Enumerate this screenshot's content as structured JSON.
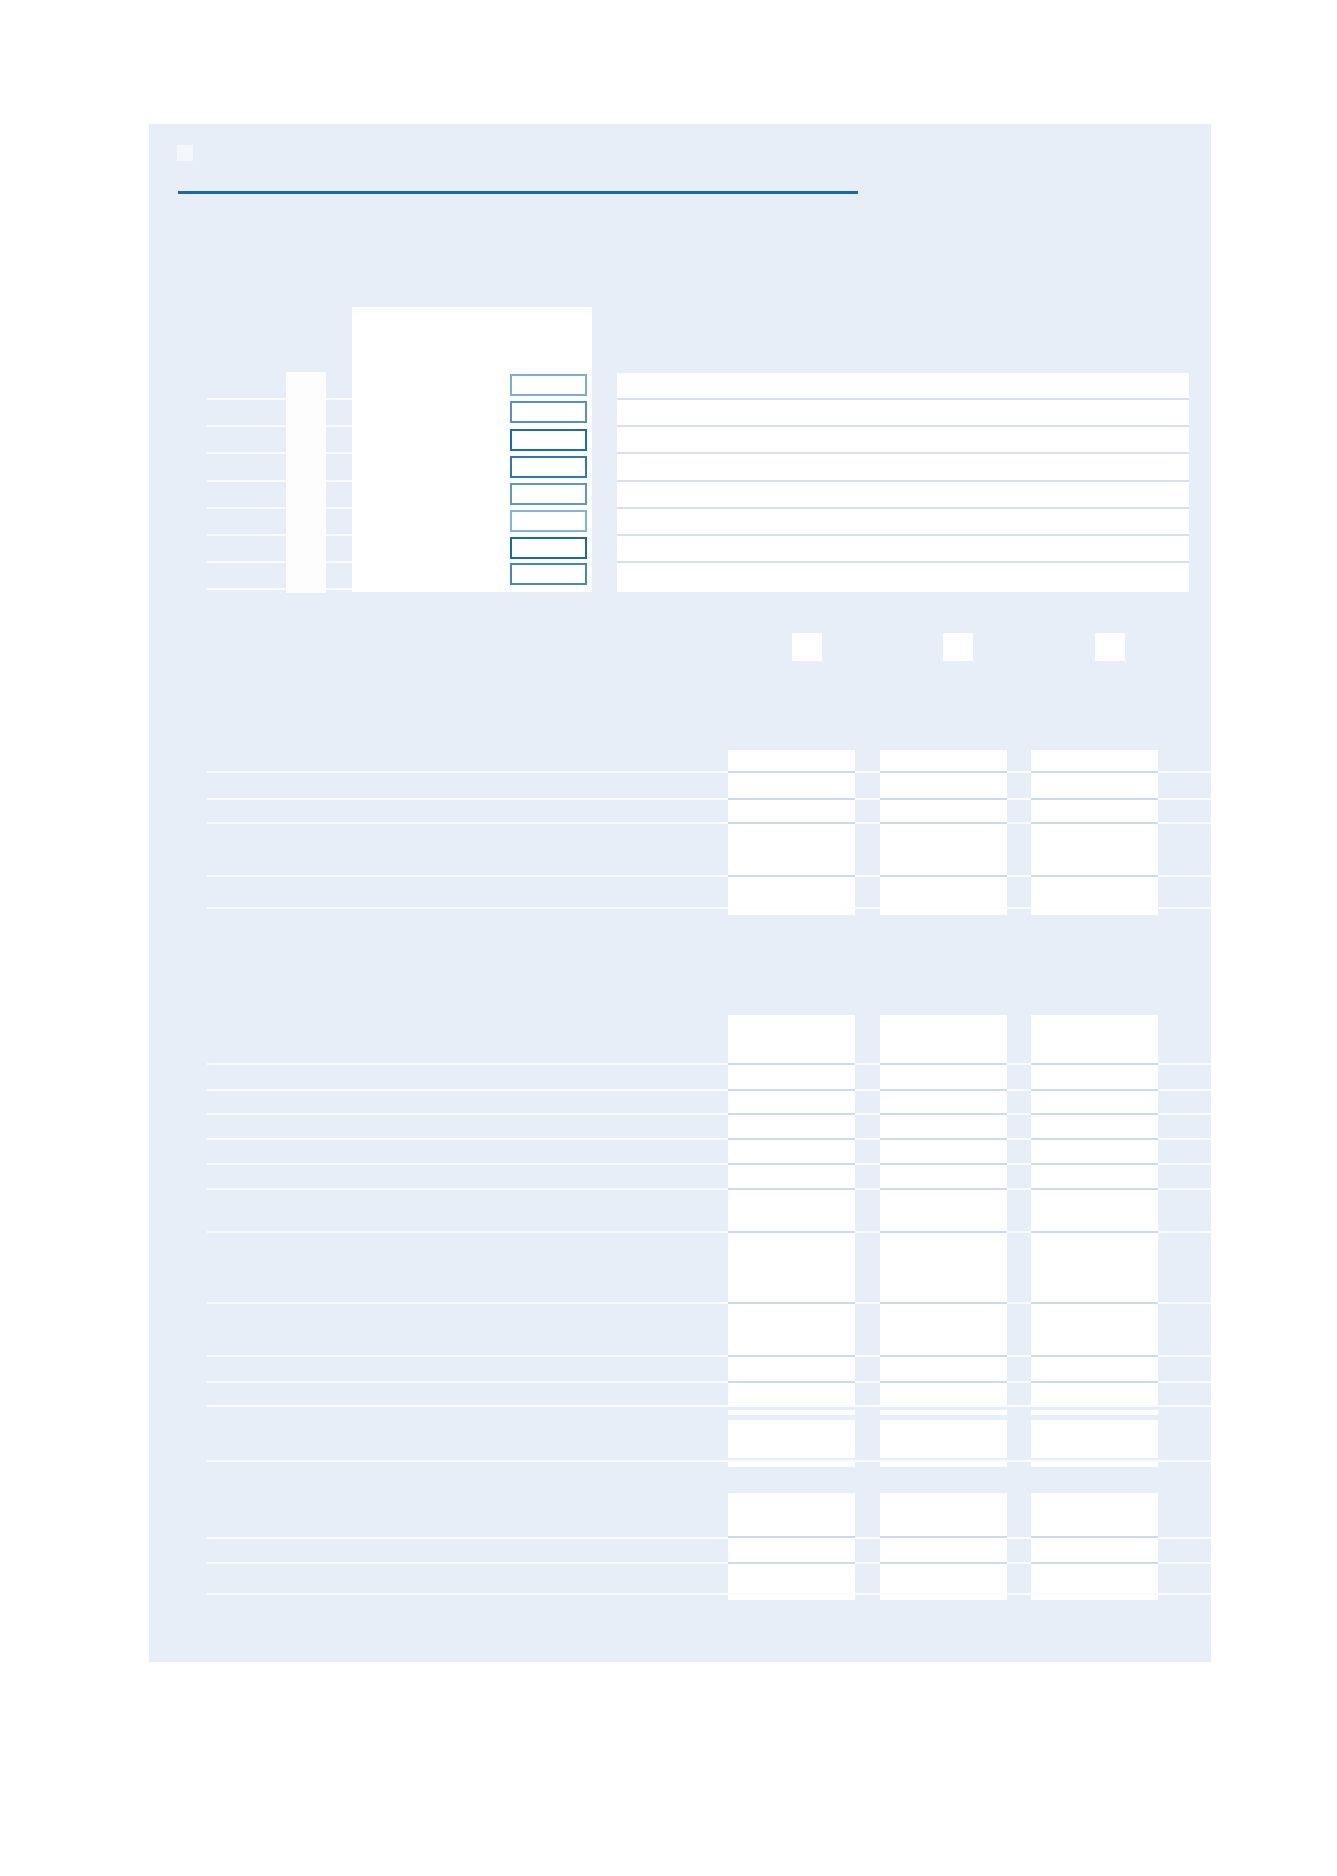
{
  "document": {
    "kind": "blank-form-template-page",
    "visible_text": "",
    "notes": "Empty form page: no text is rendered in the pixels; only panel, rule, boxes, checkboxes, row guidelines and three-column table cells."
  },
  "colors": {
    "page_bg": "#ffffff",
    "panel_bg": "#e8eef8",
    "accent_rule": "#1769ab",
    "cell_separator": "#cdd9ec",
    "answer_row_separator": "#d6e0f0",
    "guideline": "#f9fbfe",
    "block_white": "#ffffff",
    "icon_square": "#f4f8fc",
    "checkbox_fill": "#ffffff",
    "checkbox_border_colors": [
      "#79aed9",
      "#568fc4",
      "#1b6cab",
      "#2e78b5",
      "#5e98cb",
      "#82b3dc",
      "#20699f",
      "#4886bf"
    ]
  },
  "form": {
    "checkbox_count": 8,
    "answer_row_count": 8,
    "year_header_box_count": 3,
    "table_column_count": 3
  },
  "tables": [
    {
      "name": "table-1",
      "columns": 3,
      "body_row_count": 5,
      "has_total_rule": true
    },
    {
      "name": "table-2",
      "columns": 3,
      "body_row_count": 11,
      "has_total_rule": true,
      "has_extra_total_row": true
    },
    {
      "name": "table-3",
      "columns": 3,
      "body_row_count": 3,
      "has_total_rule": true
    }
  ]
}
